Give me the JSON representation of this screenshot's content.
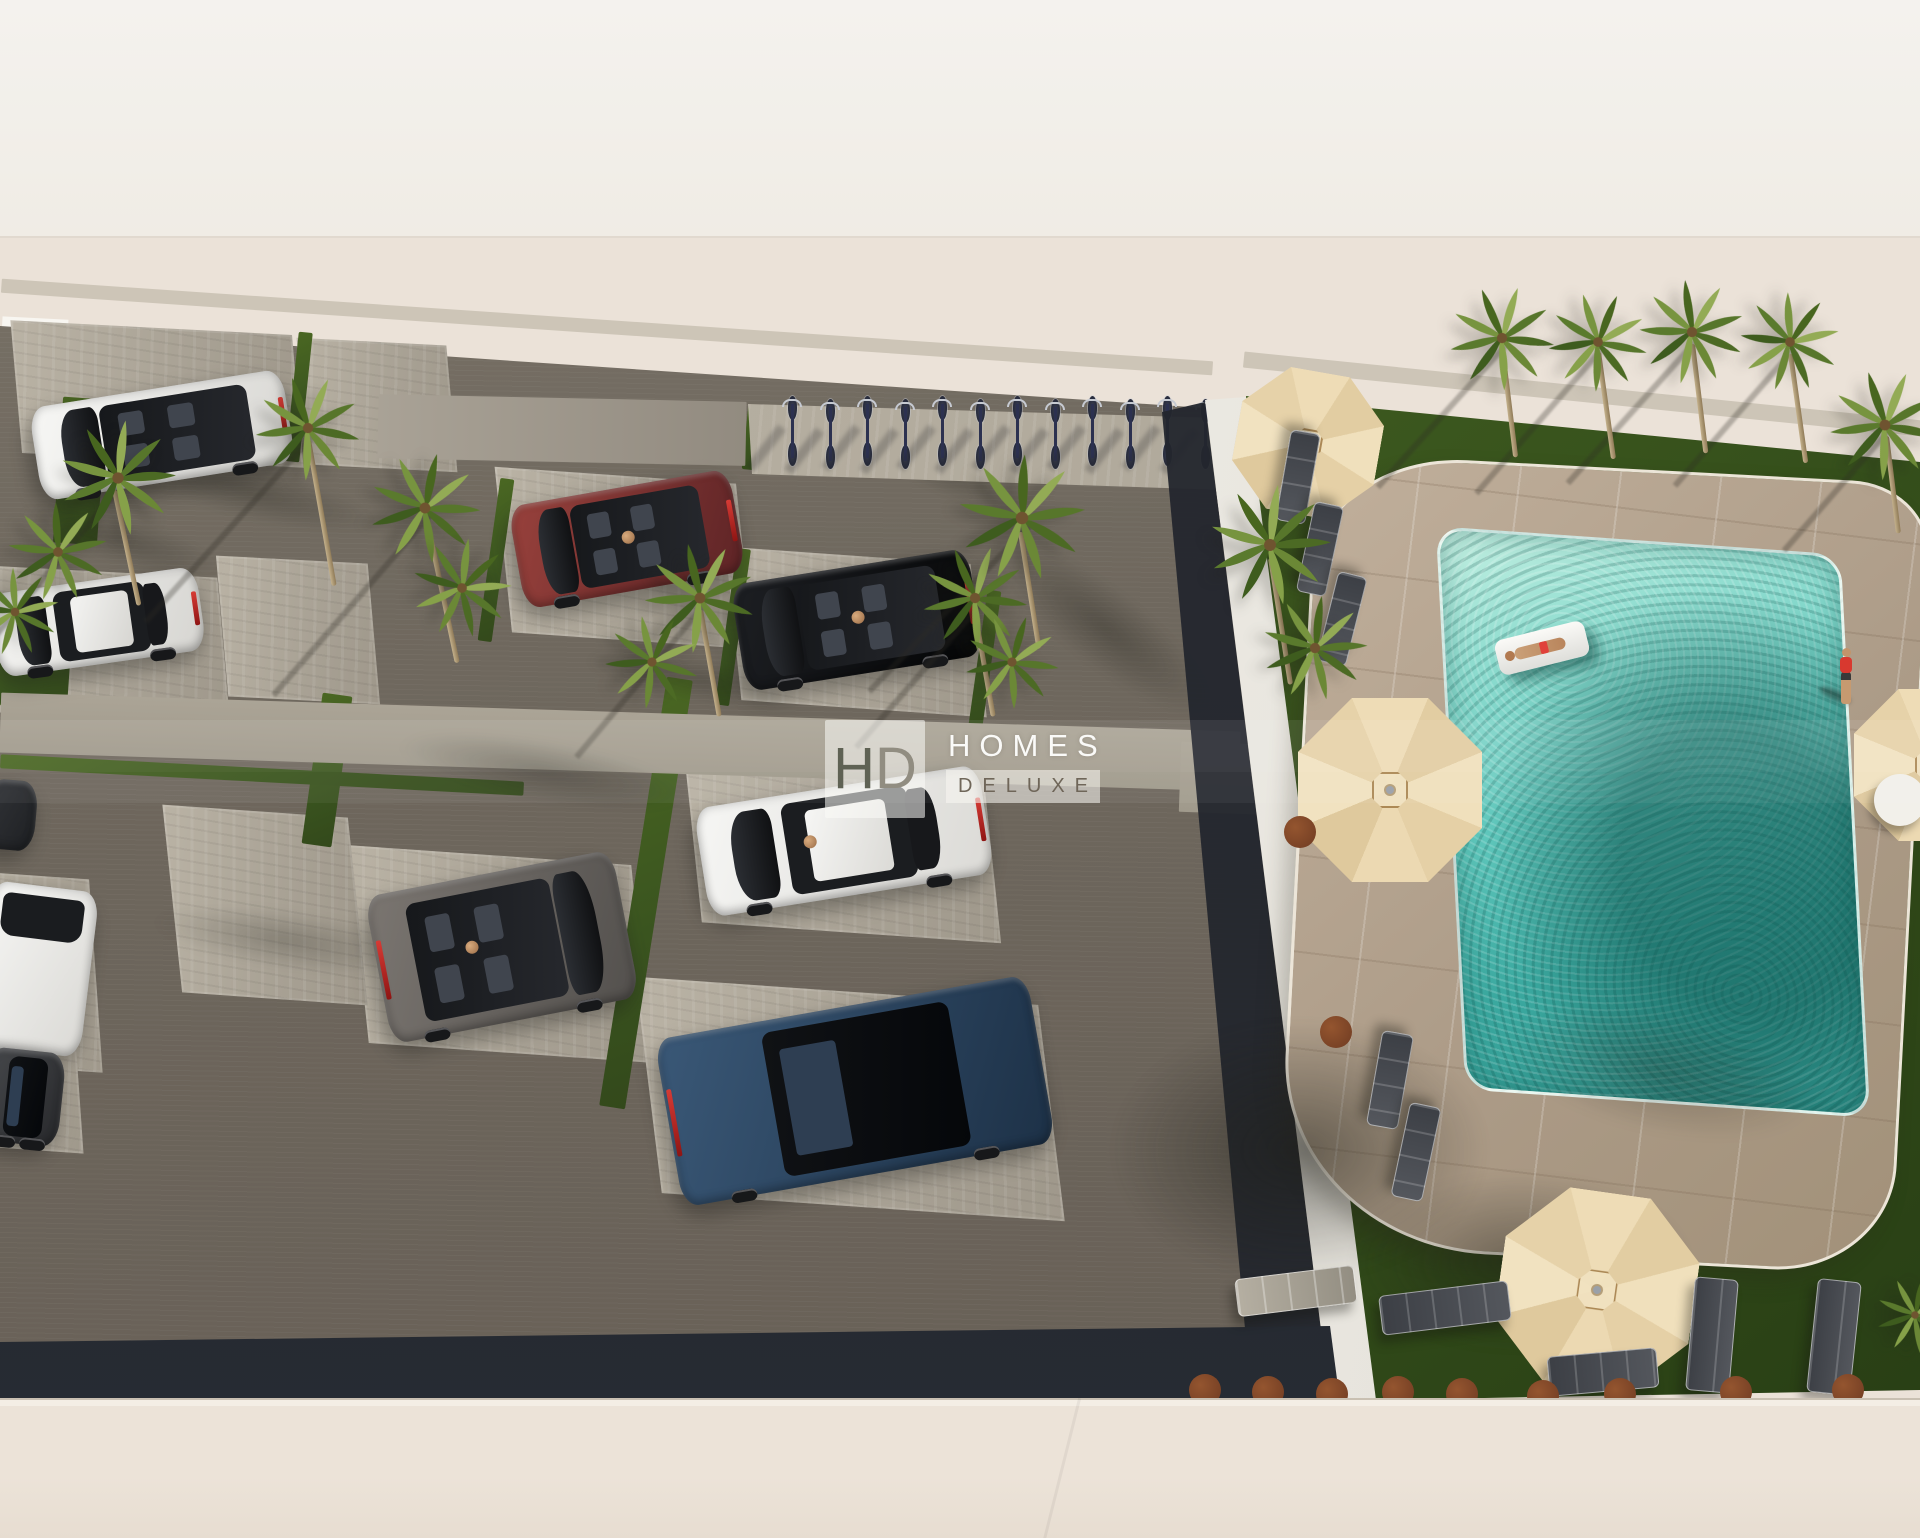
{
  "watermark": {
    "monogram_h": "H",
    "monogram_d": "D",
    "line1": "HOMES",
    "line2": "DELUXE"
  },
  "palette": {
    "sky": "#f2f0ec",
    "background": "#ebe2d8",
    "asphalt": "#6e675d",
    "paver": "#b5ae9f",
    "grass": "#3f5a22",
    "deck": "#b4a28e",
    "pool_light": "#b9ecdf",
    "pool_deep": "#2c8e88",
    "umbrella": "#e9d6ae",
    "wall": "#f2efe9",
    "wall_shadow": "#262a31",
    "street": "#e9e0d5",
    "lounger": "#43464c",
    "cushion": "#7e452c",
    "bike_frame": "#2c3150"
  },
  "counts": {
    "cars": 10,
    "palm_trees": 19,
    "bicycles": 12,
    "parasols": 4,
    "sun_loungers": 10,
    "cushions": 11
  },
  "scene": {
    "spaces": [
      [
        16,
        328,
        282,
        132,
        3,
        8
      ],
      [
        302,
        342,
        150,
        126,
        3,
        8
      ],
      [
        503,
        476,
        242,
        164,
        4,
        10
      ],
      [
        733,
        556,
        246,
        152,
        4,
        10
      ],
      [
        -8,
        572,
        232,
        146,
        3,
        8
      ],
      [
        222,
        560,
        152,
        140,
        3,
        8
      ],
      [
        693,
        772,
        300,
        160,
        4,
        10
      ],
      [
        358,
        856,
        284,
        196,
        4,
        10
      ],
      [
        172,
        812,
        186,
        186,
        4,
        10
      ],
      [
        648,
        992,
        404,
        214,
        4,
        11
      ],
      [
        -20,
        876,
        116,
        192,
        4,
        8
      ],
      [
        -12,
        1046,
        92,
        104,
        4,
        8
      ]
    ],
    "grass": [
      [
        292,
        332,
        14,
        130,
        6
      ],
      [
        489,
        478,
        14,
        164,
        8
      ],
      [
        726,
        548,
        14,
        158,
        8
      ],
      [
        977,
        590,
        14,
        150,
        8
      ],
      [
        633,
        676,
        26,
        434,
        9
      ],
      [
        312,
        694,
        30,
        152,
        8
      ],
      [
        0,
        697,
        212,
        14,
        3
      ],
      [
        0,
        768,
        524,
        14,
        3
      ],
      [
        745,
        406,
        18,
        64,
        6
      ],
      [
        0,
        618,
        70,
        88,
        4
      ],
      [
        58,
        398,
        44,
        146,
        4
      ]
    ],
    "walk": [
      [
        0,
        712,
        1240,
        60,
        1.8,
        0
      ],
      [
        1180,
        744,
        132,
        70,
        2,
        0
      ],
      [
        378,
        398,
        368,
        64,
        1.2,
        1
      ],
      [
        0,
        320,
        1214,
        14,
        3.9,
        2
      ],
      [
        1242,
        386,
        682,
        16,
        5.8,
        2
      ]
    ],
    "blobs": [
      [
        250,
        492,
        320,
        66,
        14,
        0.3,
        0
      ],
      [
        545,
        772,
        360,
        76,
        10,
        0.3,
        0
      ],
      [
        930,
        462,
        280,
        60,
        26,
        0.28,
        0
      ],
      [
        1105,
        628,
        320,
        96,
        38,
        0.33,
        0
      ],
      [
        285,
        940,
        330,
        76,
        8,
        0.25,
        0
      ],
      [
        120,
        540,
        260,
        60,
        16,
        0.28,
        0
      ],
      [
        700,
        680,
        260,
        56,
        10,
        0.25,
        0
      ],
      [
        1660,
        1072,
        380,
        150,
        12,
        0.28,
        1
      ],
      [
        1300,
        1150,
        460,
        320,
        0,
        0.5,
        1
      ],
      [
        1520,
        1262,
        420,
        220,
        0,
        0.42,
        1
      ]
    ],
    "trunks": [
      [
        112,
        490,
        118,
        -12
      ],
      [
        306,
        440,
        148,
        -10
      ],
      [
        424,
        518,
        148,
        -12
      ],
      [
        698,
        610,
        108,
        -10
      ],
      [
        972,
        610,
        108,
        -10
      ],
      [
        1018,
        532,
        118,
        -9
      ],
      [
        1268,
        558,
        128,
        -9
      ],
      [
        1500,
        350,
        108,
        -7
      ],
      [
        1596,
        352,
        108,
        -8
      ],
      [
        1690,
        344,
        110,
        -7
      ],
      [
        1788,
        354,
        110,
        -8
      ],
      [
        1884,
        436,
        98,
        -7
      ]
    ],
    "tshadows": [
      [
        118,
        486,
        230,
        40
      ],
      [
        310,
        436,
        250,
        42
      ],
      [
        428,
        514,
        240,
        41
      ],
      [
        702,
        604,
        200,
        40
      ],
      [
        978,
        604,
        190,
        41
      ],
      [
        1026,
        526,
        230,
        44
      ],
      [
        1502,
        346,
        190,
        42
      ],
      [
        1598,
        350,
        190,
        41
      ],
      [
        1692,
        342,
        190,
        42
      ],
      [
        1790,
        350,
        180,
        41
      ],
      [
        1886,
        430,
        160,
        41
      ]
    ],
    "palms": [
      [
        118,
        478,
        1.05,
        0
      ],
      [
        58,
        552,
        0.9,
        30
      ],
      [
        15,
        612,
        0.8,
        70
      ],
      [
        308,
        428,
        0.95,
        15
      ],
      [
        425,
        508,
        1.0,
        45
      ],
      [
        462,
        588,
        0.9,
        80
      ],
      [
        700,
        598,
        1.0,
        20
      ],
      [
        652,
        662,
        0.85,
        60
      ],
      [
        975,
        598,
        0.95,
        10
      ],
      [
        1012,
        662,
        0.85,
        50
      ],
      [
        1022,
        518,
        1.15,
        35
      ],
      [
        1270,
        545,
        1.1,
        0
      ],
      [
        1315,
        648,
        0.95,
        40
      ],
      [
        1502,
        338,
        0.95,
        10
      ],
      [
        1598,
        342,
        0.9,
        55
      ],
      [
        1692,
        332,
        0.95,
        25
      ],
      [
        1790,
        342,
        0.9,
        70
      ],
      [
        1885,
        425,
        1.0,
        15
      ],
      [
        1915,
        1315,
        0.7,
        45
      ]
    ],
    "bikes": {
      "x": 779,
      "y": 396,
      "dx": 37.5,
      "count": 12
    },
    "umbrellas": [
      [
        1308,
        443,
        72,
        10
      ],
      [
        1390,
        790,
        92,
        0
      ],
      [
        1597,
        1290,
        98,
        8
      ],
      [
        1930,
        765,
        76,
        0
      ]
    ],
    "loungers": [
      [
        1252,
        462,
        92,
        30,
        100,
        0
      ],
      [
        1274,
        534,
        92,
        30,
        102,
        0
      ],
      [
        1296,
        604,
        92,
        30,
        104,
        0
      ],
      [
        1342,
        1064,
        96,
        32,
        100,
        0
      ],
      [
        1368,
        1136,
        96,
        32,
        102,
        0
      ],
      [
        1236,
        1272,
        120,
        38,
        -7,
        1
      ],
      [
        1380,
        1288,
        130,
        40,
        -7,
        0
      ],
      [
        1690,
        1278,
        44,
        114,
        5,
        0
      ],
      [
        1812,
        1280,
        44,
        114,
        6,
        0
      ],
      [
        1548,
        1352,
        110,
        40,
        -5,
        0
      ]
    ],
    "cushions": [
      [
        1205,
        1390
      ],
      [
        1268,
        1392
      ],
      [
        1332,
        1394
      ],
      [
        1398,
        1392
      ],
      [
        1462,
        1394
      ],
      [
        1543,
        1396
      ],
      [
        1620,
        1394
      ],
      [
        1736,
        1392
      ],
      [
        1848,
        1390
      ],
      [
        1300,
        832
      ],
      [
        1336,
        1032
      ]
    ],
    "discs": [
      [
        1900,
        800,
        52
      ]
    ],
    "cars": [
      {
        "name": "white-range-rover",
        "x": 34,
        "y": 388,
        "w": 256,
        "h": 94,
        "rot": -9,
        "c1": "#f7f7f5",
        "c2": "#d8d7d3",
        "cabin": "open",
        "front": "left",
        "person": false,
        "tail": "right"
      },
      {
        "name": "white-coupe",
        "x": -6,
        "y": 580,
        "w": 208,
        "h": 84,
        "rot": -8,
        "c1": "#f4f4f2",
        "c2": "#d6d5d1",
        "cabin": "glass",
        "front": "left",
        "person": false,
        "tail": "right"
      },
      {
        "name": "red-hatchback",
        "x": 515,
        "y": 487,
        "w": 224,
        "h": 104,
        "rot": -10,
        "c1": "#98413c",
        "c2": "#5e2426",
        "cabin": "open",
        "front": "left",
        "person": true,
        "tail": "right"
      },
      {
        "name": "black-sedan",
        "x": 737,
        "y": 566,
        "w": 240,
        "h": 108,
        "rot": -9,
        "c1": "#1d1f23",
        "c2": "#050607",
        "cabin": "open",
        "front": "left",
        "person": true,
        "tail": "right"
      },
      {
        "name": "white-hatchback",
        "x": 700,
        "y": 786,
        "w": 288,
        "h": 110,
        "rot": -9,
        "c1": "#f6f6f4",
        "c2": "#dbdad6",
        "cabin": "glass",
        "front": "left",
        "person": true,
        "tail": "right"
      },
      {
        "name": "grey-suv",
        "x": 376,
        "y": 872,
        "w": 252,
        "h": 150,
        "rot": -11,
        "c1": "#7b7671",
        "c2": "#53504d",
        "cabin": "open",
        "front": "right",
        "person": true,
        "tail": "left"
      },
      {
        "name": "blue-suv",
        "x": 666,
        "y": 1006,
        "w": 378,
        "h": 170,
        "rot": -10,
        "c1": "#3a5877",
        "c2": "#1d3147",
        "cabin": "roof",
        "front": "right",
        "person": false,
        "tail": "left"
      },
      {
        "name": "white-suv-partial",
        "x": -18,
        "y": 886,
        "w": 108,
        "h": 166,
        "rot": 7,
        "c1": "#f6f6f4",
        "c2": "#dad9d5",
        "cabin": "rear",
        "front": "right",
        "person": false,
        "tail": "none"
      },
      {
        "name": "dark-car-partial",
        "x": -16,
        "y": 1050,
        "w": 78,
        "h": 94,
        "rot": 6,
        "c1": "#46484b",
        "c2": "#28292c",
        "cabin": "roof",
        "front": "right",
        "person": false,
        "tail": "none"
      },
      {
        "name": "dark-car-nose",
        "x": -14,
        "y": 780,
        "w": 50,
        "h": 70,
        "rot": 5,
        "c1": "#323438",
        "c2": "#1e2023",
        "cabin": "none",
        "front": "right",
        "person": false,
        "tail": "none"
      }
    ]
  }
}
